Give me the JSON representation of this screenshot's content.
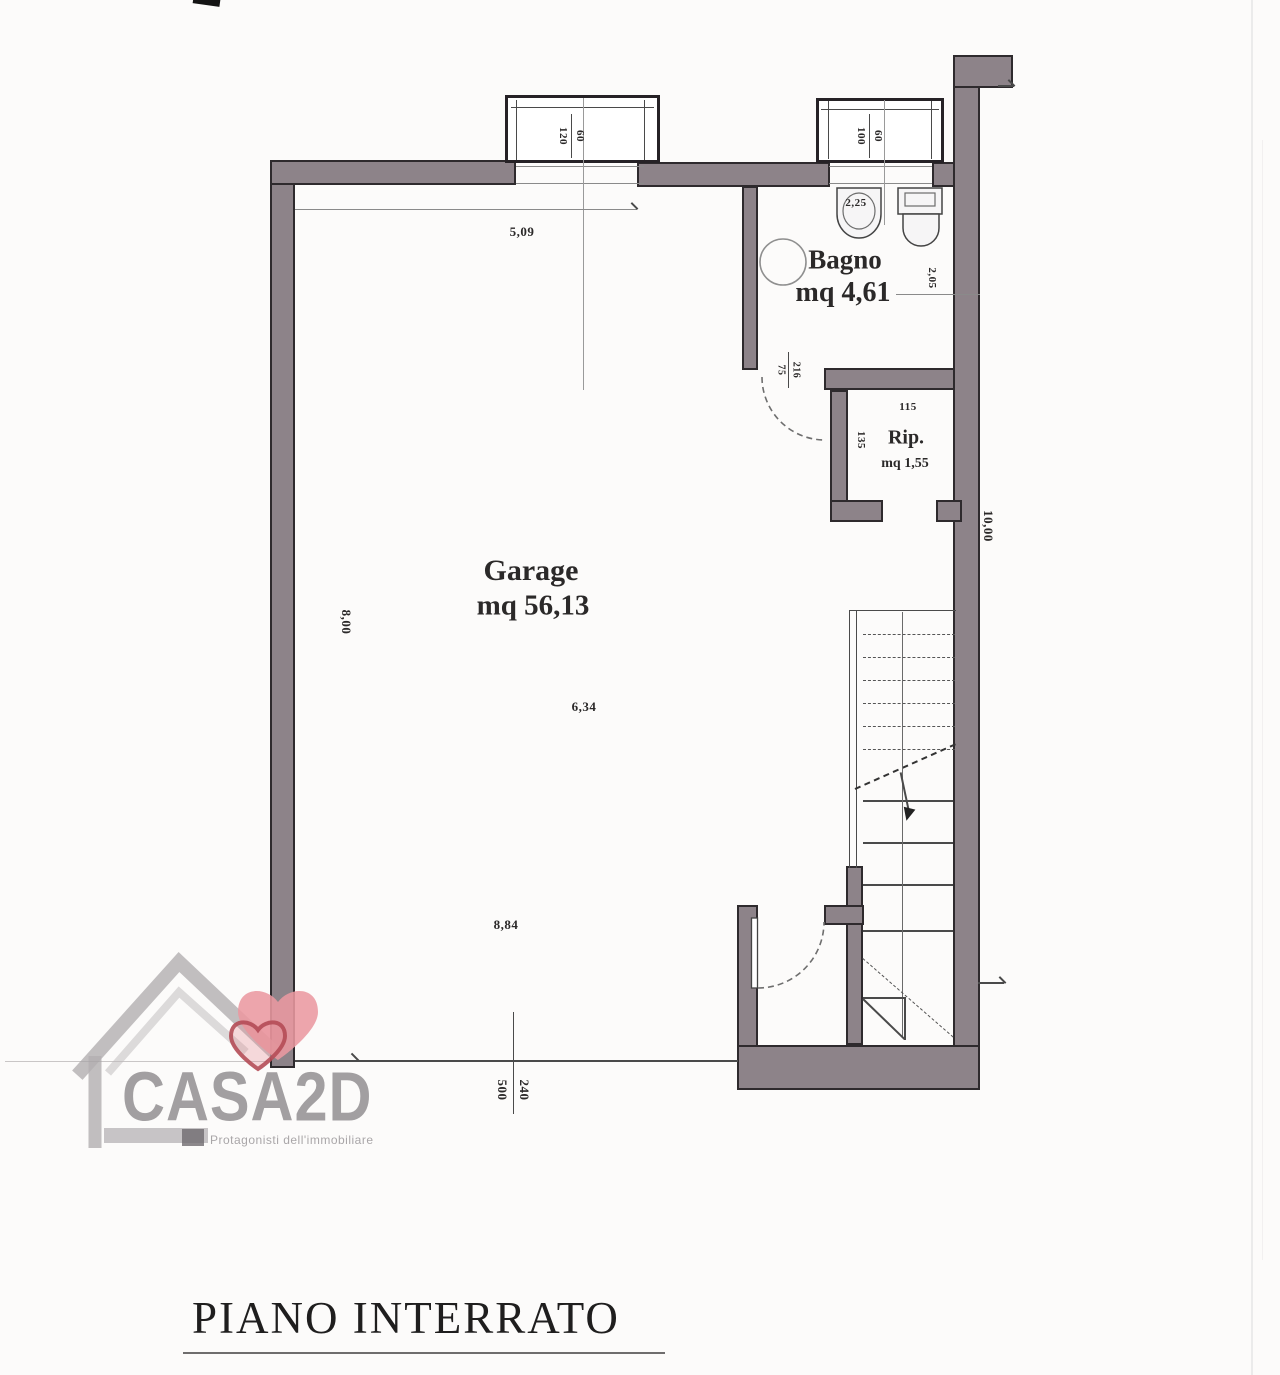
{
  "sheet": {
    "floor_title": "PIANO INTERRATO"
  },
  "logo": {
    "brand": "CASA2D",
    "tagline": "Protagonisti dell'immobiliare"
  },
  "rooms": {
    "garage": {
      "name": "Garage",
      "area": "mq 56,13"
    },
    "bagno": {
      "name": "Bagno",
      "area": "mq 4,61"
    },
    "rip": {
      "name": "Rip.",
      "area": "mq 1,55"
    }
  },
  "openings": {
    "window_left": {
      "width": "120",
      "height": "60"
    },
    "window_right": {
      "width": "100",
      "height": "60"
    },
    "door_bagno": {
      "width": "75",
      "height": "216"
    },
    "garage_door": {
      "width": "500",
      "height": "240"
    }
  },
  "dimensions": {
    "garage_top_width": "5,09",
    "garage_mid_width": "6,34",
    "garage_bottom_width": "8,84",
    "garage_left_height": "8,00",
    "right_side_height": "10,00",
    "bagno_width": "2,25",
    "bagno_depth": "2,05",
    "rip_width": "115",
    "rip_depth": "135"
  },
  "colors": {
    "wall_fill": "#8d8389",
    "heart": "#eb98a0",
    "logo_gray": "#9c999b"
  }
}
